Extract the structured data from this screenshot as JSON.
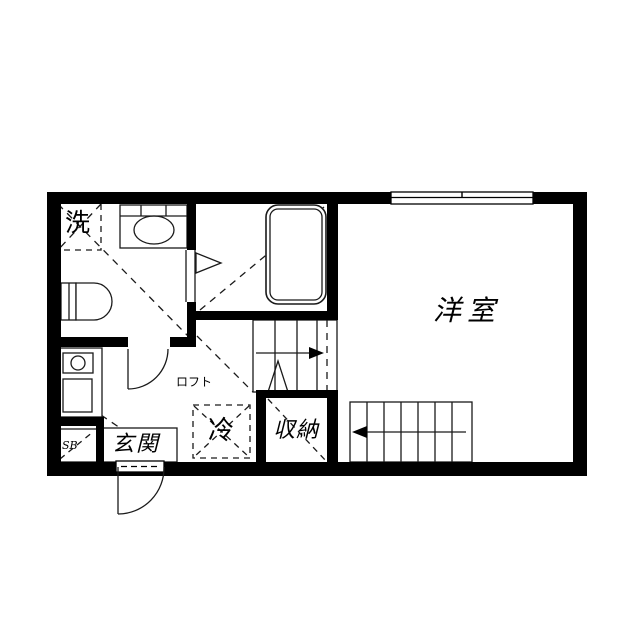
{
  "floorplan": {
    "type": "japanese-apartment-floor-plan",
    "background_color": "#ffffff",
    "wall_color": "#000000",
    "line_color": "#1a1a1a",
    "labels": {
      "washer": "洗",
      "western_room": "洋室",
      "refrigerator": "冷",
      "storage": "収納",
      "entrance": "玄関",
      "loft": "ロフト",
      "shoe_box": "SB"
    }
  }
}
